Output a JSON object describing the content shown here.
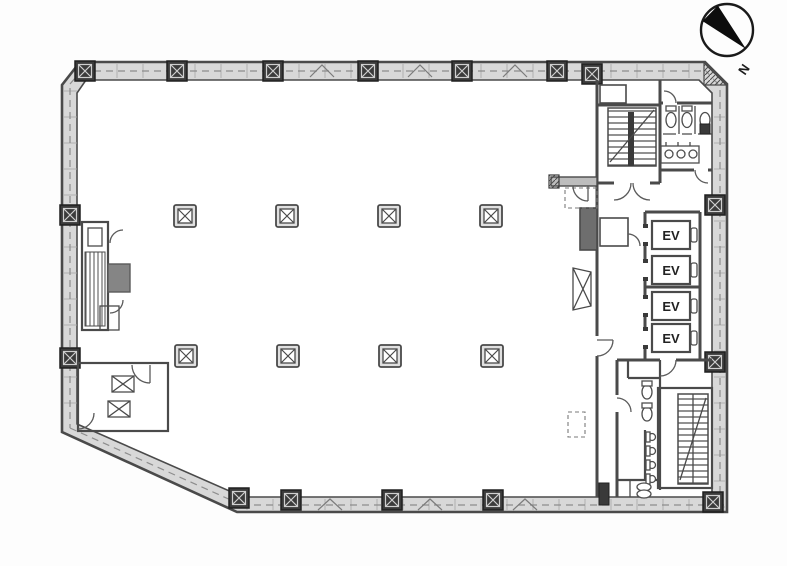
{
  "plan": {
    "compass": {
      "north_label": "N"
    },
    "elevators": [
      {
        "label": "EV"
      },
      {
        "label": "EV"
      },
      {
        "label": "EV"
      },
      {
        "label": "EV"
      }
    ]
  },
  "colors": {
    "line": "#4a4a4a",
    "band": "#d8d8d8",
    "column": "#3b3b3b",
    "shaft": "#6e6e6e",
    "block": "#858585",
    "background": "#fdfdfd",
    "labelink": "#222222"
  }
}
